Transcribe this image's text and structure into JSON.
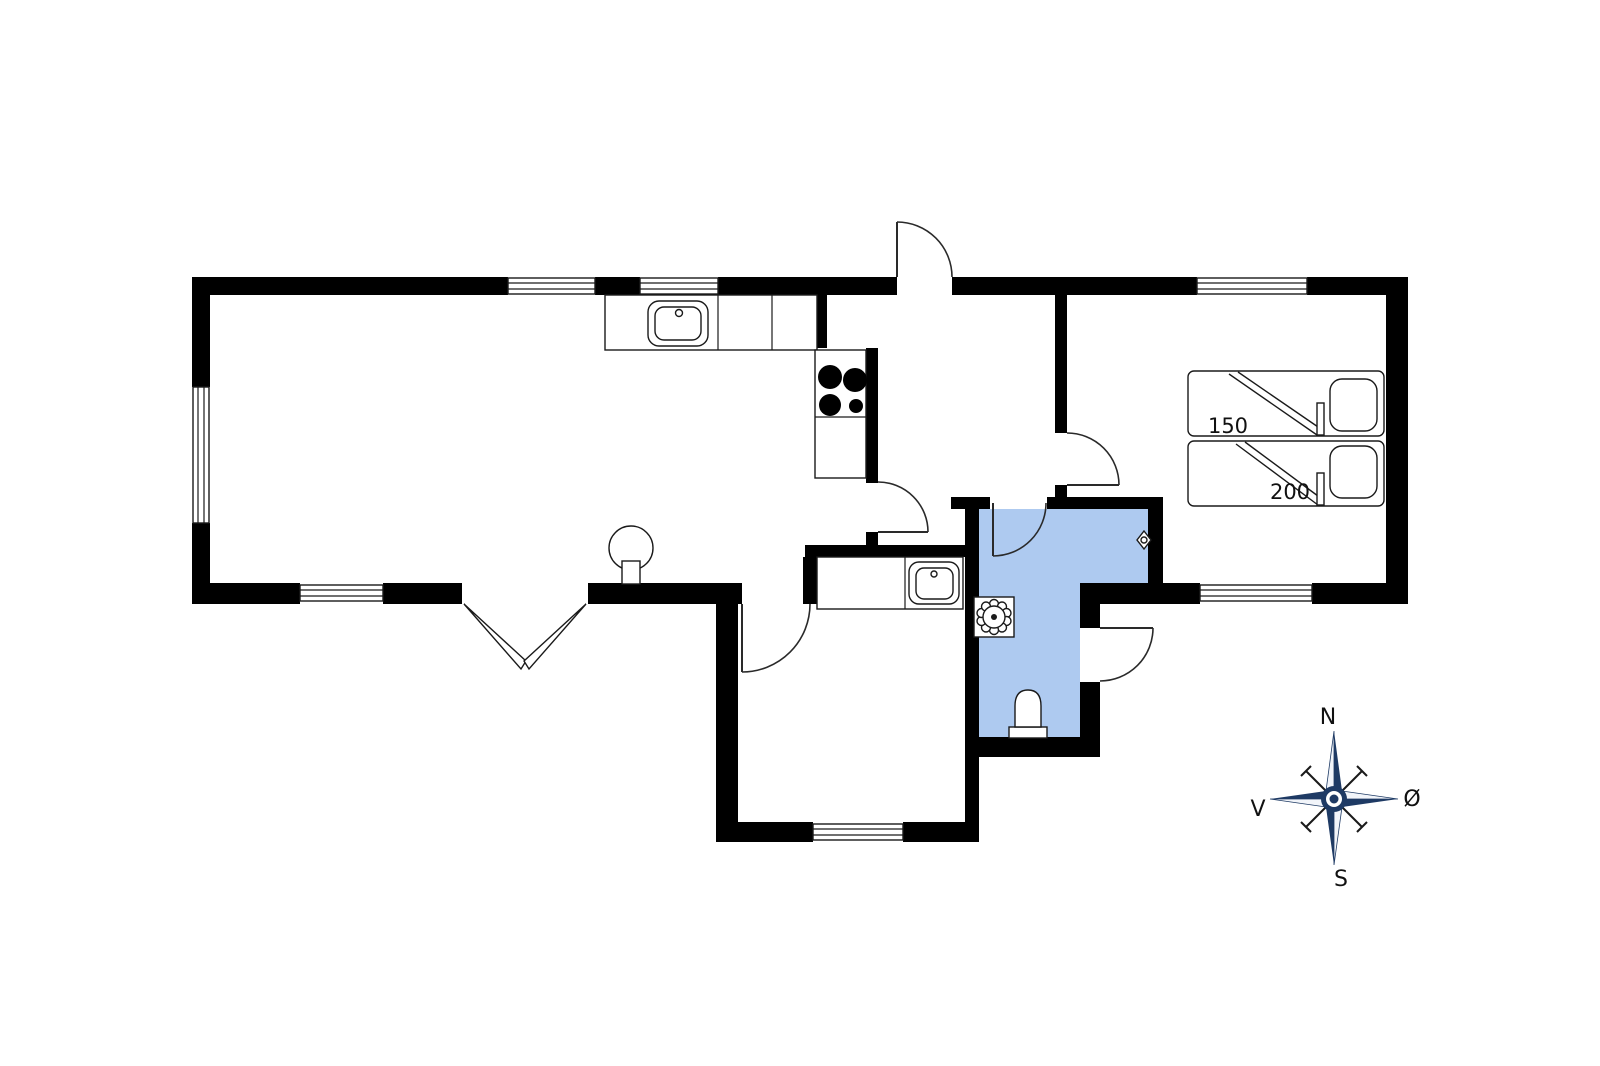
{
  "colors": {
    "wall": "#000000",
    "bathroom_fill": "#AECAF0",
    "compass_navy": "#1E3A64",
    "line": "#1A1A1A",
    "background": "#FFFFFF"
  },
  "bed": {
    "width_label": "150",
    "length_label": "200"
  },
  "compass": {
    "north_label": "N",
    "east_label": "Ø",
    "south_label": "S",
    "west_label": "V"
  },
  "icons": {
    "kitchen_sink": "sink-top-view",
    "utility_sink": "sink-top-view",
    "cooktop": "cooktop-four-burners",
    "wood_stove": "wood-stove-round",
    "toilet": "toilet-top-view",
    "shower_drain": "floor-drain-flower",
    "vent_valve": "small-diamond-vent",
    "compass_rose": "four-point-compass"
  }
}
